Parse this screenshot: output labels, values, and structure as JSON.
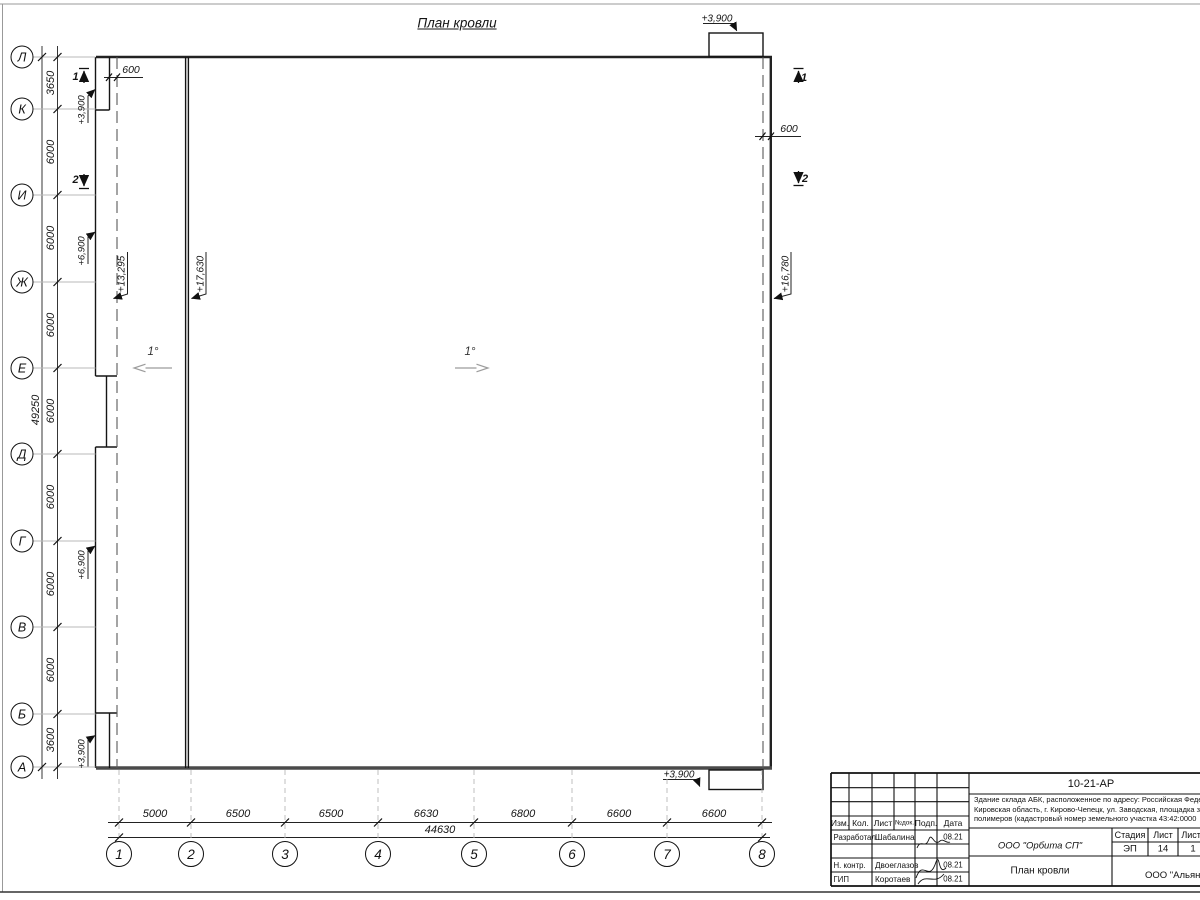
{
  "title": "План кровли",
  "axes": {
    "rows": [
      {
        "label": "Л",
        "y": 57
      },
      {
        "label": "К",
        "y": 109
      },
      {
        "label": "И",
        "y": 195
      },
      {
        "label": "Ж",
        "y": 282
      },
      {
        "label": "Е",
        "y": 368
      },
      {
        "label": "Д",
        "y": 454
      },
      {
        "label": "Г",
        "y": 541
      },
      {
        "label": "В",
        "y": 627
      },
      {
        "label": "Б",
        "y": 714
      },
      {
        "label": "А",
        "y": 767
      }
    ],
    "cols": [
      {
        "label": "1",
        "x": 119
      },
      {
        "label": "2",
        "x": 191
      },
      {
        "label": "3",
        "x": 285
      },
      {
        "label": "4",
        "x": 378
      },
      {
        "label": "5",
        "x": 474
      },
      {
        "label": "6",
        "x": 572
      },
      {
        "label": "7",
        "x": 667
      },
      {
        "label": "8",
        "x": 762
      }
    ]
  },
  "dims": {
    "vertical_bays": [
      {
        "text": "3650",
        "y": 83
      },
      {
        "text": "6000",
        "y": 152
      },
      {
        "text": "6000",
        "y": 238
      },
      {
        "text": "6000",
        "y": 325
      },
      {
        "text": "6000",
        "y": 411
      },
      {
        "text": "6000",
        "y": 497
      },
      {
        "text": "6000",
        "y": 584
      },
      {
        "text": "6000",
        "y": 670
      },
      {
        "text": "3600",
        "y": 740
      }
    ],
    "vertical_total": "49250",
    "horizontal_bays": [
      {
        "text": "5000",
        "x": 155
      },
      {
        "text": "6500",
        "x": 238
      },
      {
        "text": "6500",
        "x": 331
      },
      {
        "text": "6630",
        "x": 426
      },
      {
        "text": "6800",
        "x": 523
      },
      {
        "text": "6600",
        "x": 619
      },
      {
        "text": "6600",
        "x": 714
      }
    ],
    "horizontal_total": "44630",
    "parapet_left": "600",
    "parapet_right": "600"
  },
  "elevations": {
    "left": [
      "+3,900",
      "+6,900",
      "+6,900",
      "+3,900"
    ],
    "roof": [
      "+13,295",
      "+17,630",
      "+16,780"
    ],
    "canopy_top": "+3,900",
    "canopy_bottom": "+3,900"
  },
  "slopes": {
    "left": "1°",
    "right": "1°"
  },
  "sections": {
    "s1": "1",
    "s2": "2"
  },
  "titleblock": {
    "doc_number": "10-21-АР",
    "description_lines": [
      "Здание склада АБК, расположенное по адресу: Российская Феде",
      "Кировская область, г. Кирово-Чепецк, ул. Заводская, площадка з",
      "полимеров (кадастровый номер земельного участка 43:42:0000"
    ],
    "columns": [
      "Изм.",
      "Кол.",
      "Лист",
      "№док.",
      "Подп.",
      "Дата"
    ],
    "people": [
      {
        "role": "Разработал",
        "name": "Шабалина",
        "date": "08.21"
      },
      {
        "role": "Н. контр.",
        "name": "Двоеглазов",
        "date": "08.21"
      },
      {
        "role": "ГИП",
        "name": "Коротаев",
        "date": "08.21"
      }
    ],
    "design_company": "ООО \"Орбита СП\"",
    "sheet_title": "План кровли",
    "client_company": "ООО \"Альянс",
    "stage_label": "Стадия",
    "stage_value": "ЭП",
    "sheet_label": "Лист",
    "sheet_value": "14",
    "total_label": "Листов",
    "total_value": "1"
  }
}
